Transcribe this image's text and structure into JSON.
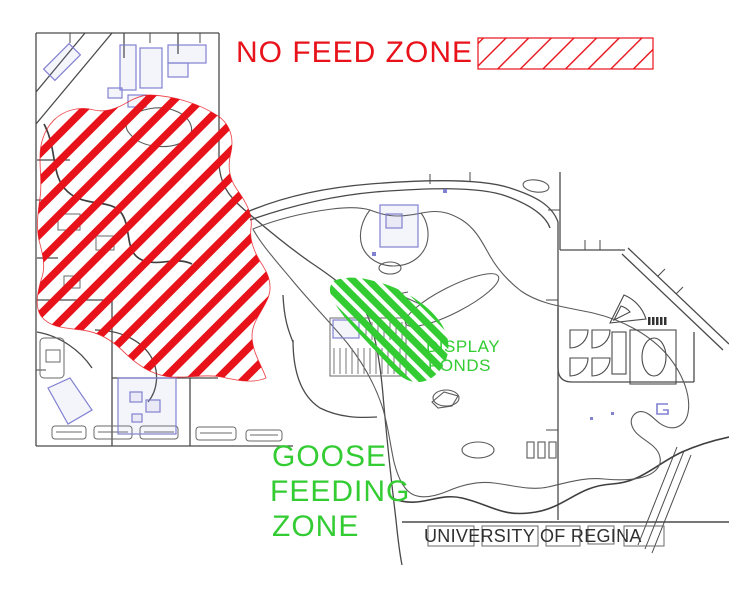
{
  "colors": {
    "no_feed_red": "#e8121a",
    "goose_green": "#33cc33",
    "map_line": "#4a4a4a",
    "shore_line": "#5a5a5a",
    "building_blue": "#8181d2",
    "footer_text": "#2f2f2f",
    "background": "#ffffff"
  },
  "header": {
    "no_feed_label": "NO FEED ZONE",
    "legend_swatch": "red-diagonal-hatch"
  },
  "goose_zone": {
    "lines": [
      "GOOSE",
      "FEEDING",
      "ZONE"
    ]
  },
  "display_ponds": {
    "lines": [
      "DISPLAY",
      "PONDS"
    ]
  },
  "footer": {
    "map_label": "UNIVERSITY OF REGINA"
  }
}
